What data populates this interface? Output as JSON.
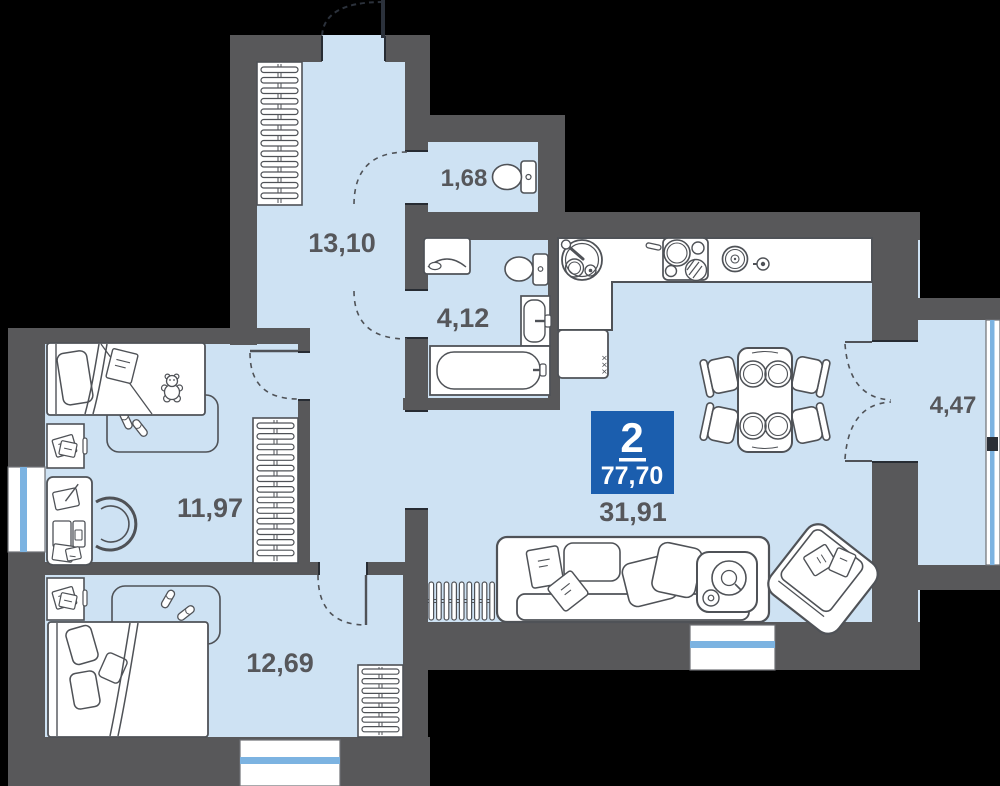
{
  "unit": {
    "rooms_count": "2",
    "total_area": "77,70"
  },
  "rooms": {
    "hallway": {
      "label": "13,10"
    },
    "wc": {
      "label": "1,68"
    },
    "bathroom": {
      "label": "4,12"
    },
    "kitchen_living": {
      "label": "31,91"
    },
    "bedroom1": {
      "label": "11,97"
    },
    "bedroom2": {
      "label": "12,69"
    },
    "balcony": {
      "label": "4,47"
    }
  },
  "decor": {
    "fridge_door_marks": "×××"
  },
  "colors": {
    "background": "#000000",
    "wall": "#58585a",
    "floor": "#cee2f3",
    "furniture": "#ffffff",
    "outline": "#4f5257",
    "glass": "#7cb3e1",
    "badge_bg": "#1b5eae",
    "badge_text": "#ffffff",
    "label": "#56575b",
    "door": "#2b313b"
  }
}
